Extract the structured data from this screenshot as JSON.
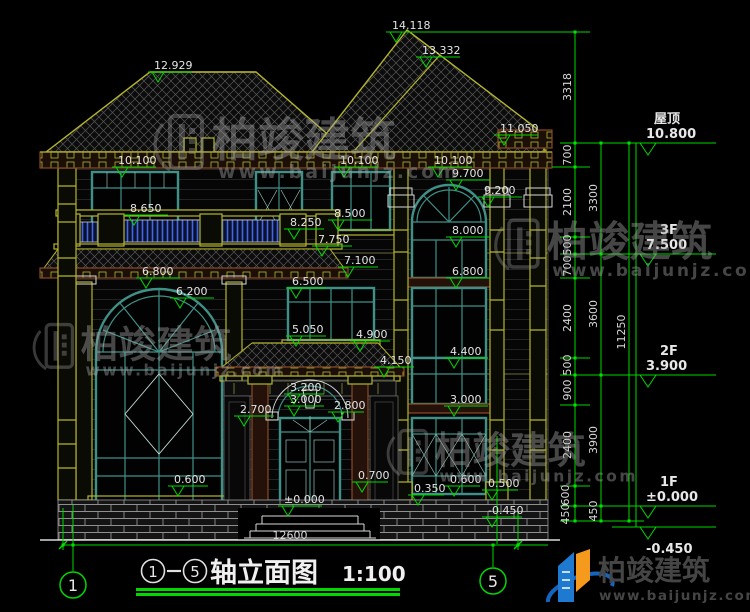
{
  "drawing_title": {
    "axis_start": "1",
    "axis_end": "5",
    "name": "轴立面图",
    "scale": "1:100"
  },
  "overall_width_dim": "12600",
  "axis_bubbles": {
    "left": "1",
    "right": "5"
  },
  "floor_levels": [
    {
      "label": "屋顶",
      "elevation": "10.800"
    },
    {
      "label": "3F",
      "elevation": "7.500"
    },
    {
      "label": "2F",
      "elevation": "3.900"
    },
    {
      "label": "1F",
      "elevation": "±0.000"
    },
    {
      "label": "",
      "elevation": "-0.450"
    }
  ],
  "dimension_chains": {
    "inner": [
      "700",
      "2100",
      "500",
      "700",
      "2400",
      "500",
      "900",
      "2400",
      "600",
      "450"
    ],
    "middle": [
      "3300",
      "3600",
      "3900",
      "450"
    ],
    "outer": [
      "3318",
      "11250"
    ]
  },
  "elevation_marks": [
    "12.929",
    "14.118",
    "13.332",
    "11.050",
    "10.100",
    "10.100",
    "10.100",
    "9.700",
    "9.200",
    "8.650",
    "8.500",
    "8.250",
    "8.000",
    "7.750",
    "7.100",
    "6.800",
    "6.800",
    "6.500",
    "6.200",
    "5.050",
    "4.900",
    "4.400",
    "4.150",
    "3.200",
    "3.000",
    "2.800",
    "2.700",
    "3.000",
    "0.700",
    "0.600",
    "0.600",
    "0.500",
    "0.350",
    "±0.000",
    "-0.450"
  ],
  "watermark": {
    "company": "柏竣建筑",
    "website": "www.baijunjz.com"
  },
  "logo": {
    "company": "柏竣建筑",
    "website": "www.baijunjz.com"
  },
  "colors": {
    "dimension_green": "#00d800",
    "label_white": "#e4e4e4",
    "trim_yellow": "#b5b52d",
    "window_teal": "#3f9187",
    "fascia_brown": "#8a4a28",
    "balustrade_blue": "#4468e0",
    "watermark_gray": "#a8a8a8",
    "logo_blue": "#1e7ad0",
    "logo_orange": "#f59a1d"
  }
}
